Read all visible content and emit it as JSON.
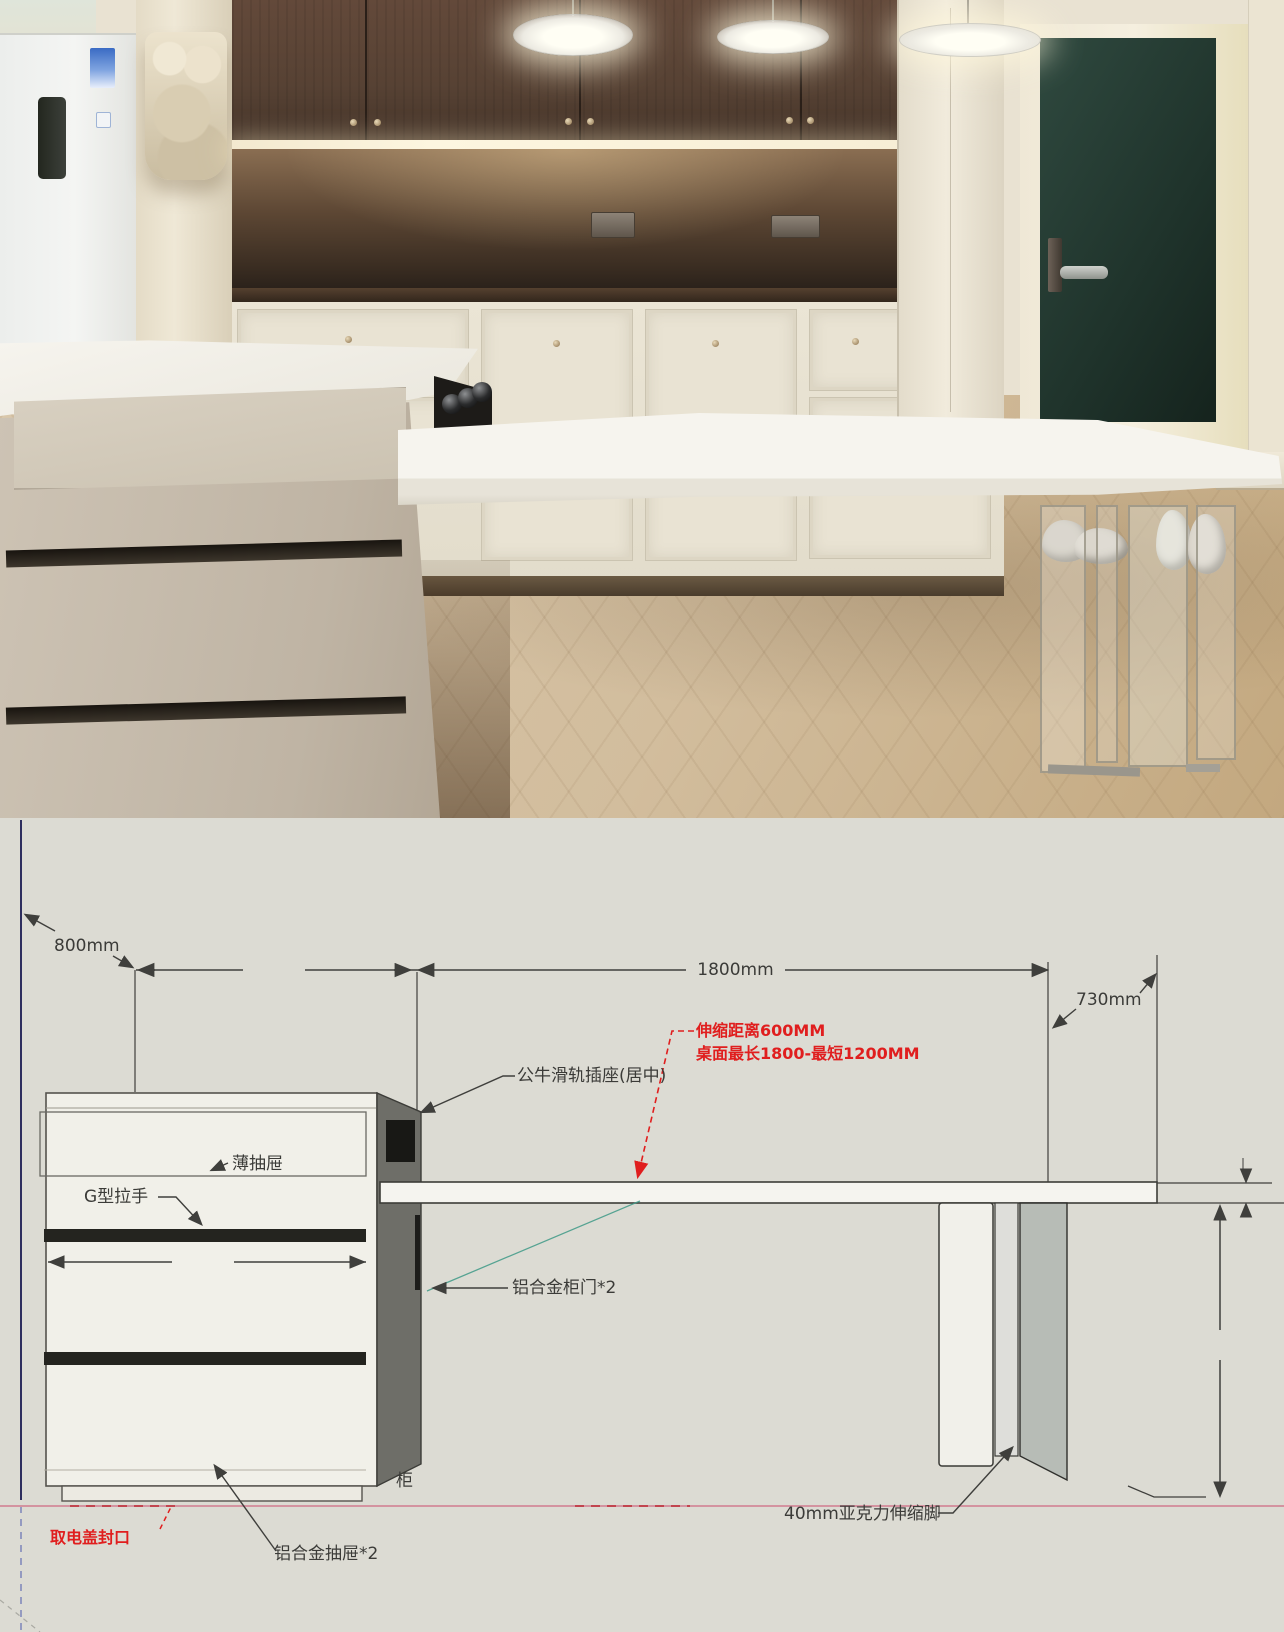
{
  "page": {
    "type": "kitchen-island-extending-table-design",
    "sections": [
      "reference-photo",
      "dimension-diagram"
    ]
  },
  "diagram": {
    "dims": {
      "wall_offset": "800mm",
      "island_width": "800mm",
      "table_length": "1800mm",
      "right_offset": "730mm",
      "drawer_width": "740mm",
      "table_height": "750mm",
      "top_thickness": "50mm"
    },
    "notes": {
      "red_line1": "伸缩距离600MM",
      "red_line2": "桌面最长1800-最短1200MM"
    },
    "labels": {
      "socket": "公牛滑轨插座(居中)",
      "thin_drawer": "薄抽屉",
      "g_handle": "G型拉手",
      "alu_door": "铝合金柜门*2",
      "alu_drawer": "铝合金抽屉*2",
      "power_cover": "取电盖封口",
      "acrylic_feet": "40mm亚克力伸缩脚",
      "inner_cabinet": "柜"
    },
    "colors": {
      "annotation_red": "#e01e1e",
      "guide_teal": "#3f9a87",
      "ground_pink": "#d493a0",
      "line": "#4a4a46",
      "background": "#dcdbd3"
    }
  }
}
